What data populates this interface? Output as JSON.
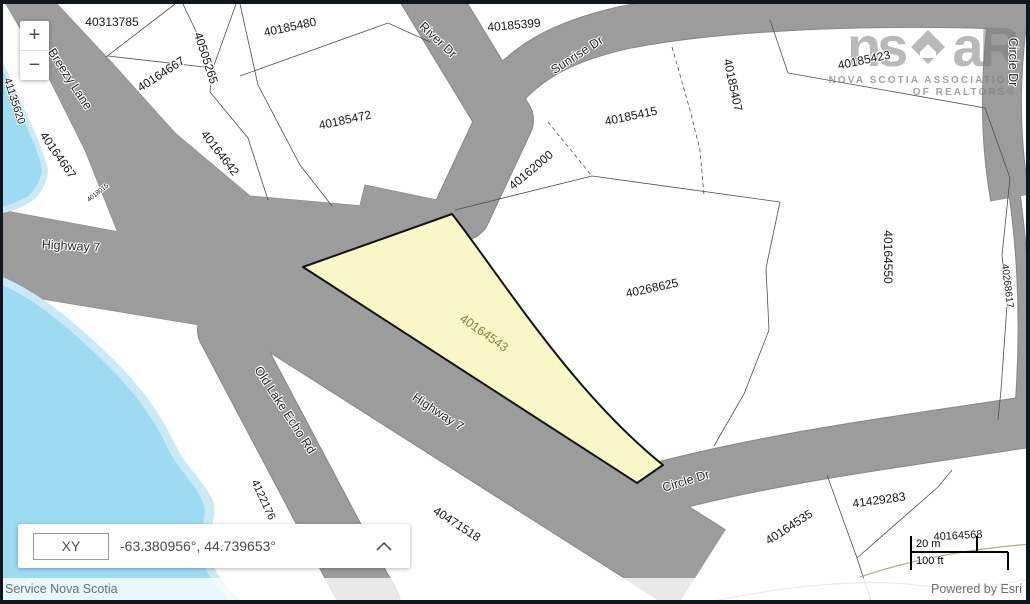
{
  "map": {
    "labels": [
      {
        "text": "40313785",
        "x": 112,
        "y": 22,
        "rot": 0,
        "kind": "parcel"
      },
      {
        "text": "40164667",
        "x": 161,
        "y": 74,
        "rot": -33,
        "kind": "parcel"
      },
      {
        "text": "40505265",
        "x": 206,
        "y": 58,
        "rot": 72,
        "kind": "parcel"
      },
      {
        "text": "40164642",
        "x": 220,
        "y": 153,
        "rot": 52,
        "kind": "parcel"
      },
      {
        "text": "40185480",
        "x": 290,
        "y": 27,
        "rot": -12,
        "kind": "parcel"
      },
      {
        "text": "40185472",
        "x": 345,
        "y": 120,
        "rot": -12,
        "kind": "parcel"
      },
      {
        "text": "40185399",
        "x": 514,
        "y": 25,
        "rot": -5,
        "kind": "parcel"
      },
      {
        "text": "40162000",
        "x": 531,
        "y": 170,
        "rot": -40,
        "kind": "parcel"
      },
      {
        "text": "40185415",
        "x": 631,
        "y": 116,
        "rot": -12,
        "kind": "parcel"
      },
      {
        "text": "40185407",
        "x": 733,
        "y": 85,
        "rot": 78,
        "kind": "parcel"
      },
      {
        "text": "40185423",
        "x": 864,
        "y": 60,
        "rot": -12,
        "kind": "parcel"
      },
      {
        "text": "40268625",
        "x": 652,
        "y": 288,
        "rot": -12,
        "kind": "parcel"
      },
      {
        "text": "40164550",
        "x": 888,
        "y": 257,
        "rot": 90,
        "kind": "parcel"
      },
      {
        "text": "40268617",
        "x": 1007,
        "y": 286,
        "rot": 83,
        "kind": "parcel",
        "size": 10
      },
      {
        "text": "41135620",
        "x": 14,
        "y": 101,
        "rot": 72,
        "kind": "parcel",
        "size": 11
      },
      {
        "text": "40164667",
        "x": 58,
        "y": 155,
        "rot": 55,
        "kind": "parcel"
      },
      {
        "text": "4018015",
        "x": 98,
        "y": 193,
        "rot": -38,
        "kind": "parcel",
        "size": 6.5
      },
      {
        "text": "4122176",
        "x": 263,
        "y": 500,
        "rot": 65,
        "kind": "parcel",
        "size": 11
      },
      {
        "text": "40471518",
        "x": 457,
        "y": 524,
        "rot": 33,
        "kind": "parcel"
      },
      {
        "text": "40164535",
        "x": 789,
        "y": 527,
        "rot": -33,
        "kind": "parcel"
      },
      {
        "text": "41429283",
        "x": 879,
        "y": 500,
        "rot": -8,
        "kind": "parcel"
      },
      {
        "text": "40164568",
        "x": 958,
        "y": 536,
        "rot": -3,
        "kind": "parcel",
        "size": 11
      },
      {
        "text": "40164543",
        "x": 484,
        "y": 333,
        "rot": 35,
        "kind": "highlight"
      },
      {
        "text": "Breezy Lane",
        "x": 70,
        "y": 79,
        "rot": 57,
        "kind": "road"
      },
      {
        "text": "River Dr",
        "x": 438,
        "y": 40,
        "rot": 43,
        "kind": "road"
      },
      {
        "text": "Sunrise Dr",
        "x": 577,
        "y": 55,
        "rot": -33,
        "kind": "road"
      },
      {
        "text": "Circle Dr",
        "x": 1013,
        "y": 62,
        "rot": 90,
        "kind": "road"
      },
      {
        "text": "Highway 7",
        "x": 71,
        "y": 246,
        "rot": 3,
        "kind": "road"
      },
      {
        "text": "Highway 7",
        "x": 438,
        "y": 412,
        "rot": 33,
        "kind": "road"
      },
      {
        "text": "Old Lake Echo Rd",
        "x": 285,
        "y": 410,
        "rot": 57,
        "kind": "road"
      },
      {
        "text": "Circle Dr",
        "x": 686,
        "y": 481,
        "rot": -17,
        "kind": "road"
      }
    ],
    "highlighted_parcel": "40164543",
    "colors": {
      "road": "#9c9c9c",
      "highlight_fill": "#faf7c6",
      "lake": "#9ddbf2",
      "lake_band": "#c9e9f7",
      "parcel_line": "#4e4e4e",
      "contour": "#b7aa8e"
    }
  },
  "controls": {
    "zoom_in": "+",
    "zoom_out": "−"
  },
  "coordinate_widget": {
    "mode": "XY",
    "value": "-63.380956°, 44.739653°"
  },
  "scale_bar": {
    "metric": "20 m",
    "imperial": "100 ft"
  },
  "attribution": {
    "left": "Service Nova Scotia",
    "right": "Powered by Esri"
  },
  "watermark": {
    "logo_left": "ns",
    "logo_right": "aR",
    "line1": "NOVA SCOTIA ASSOCIATION",
    "line2": "OF REALTORS®"
  }
}
